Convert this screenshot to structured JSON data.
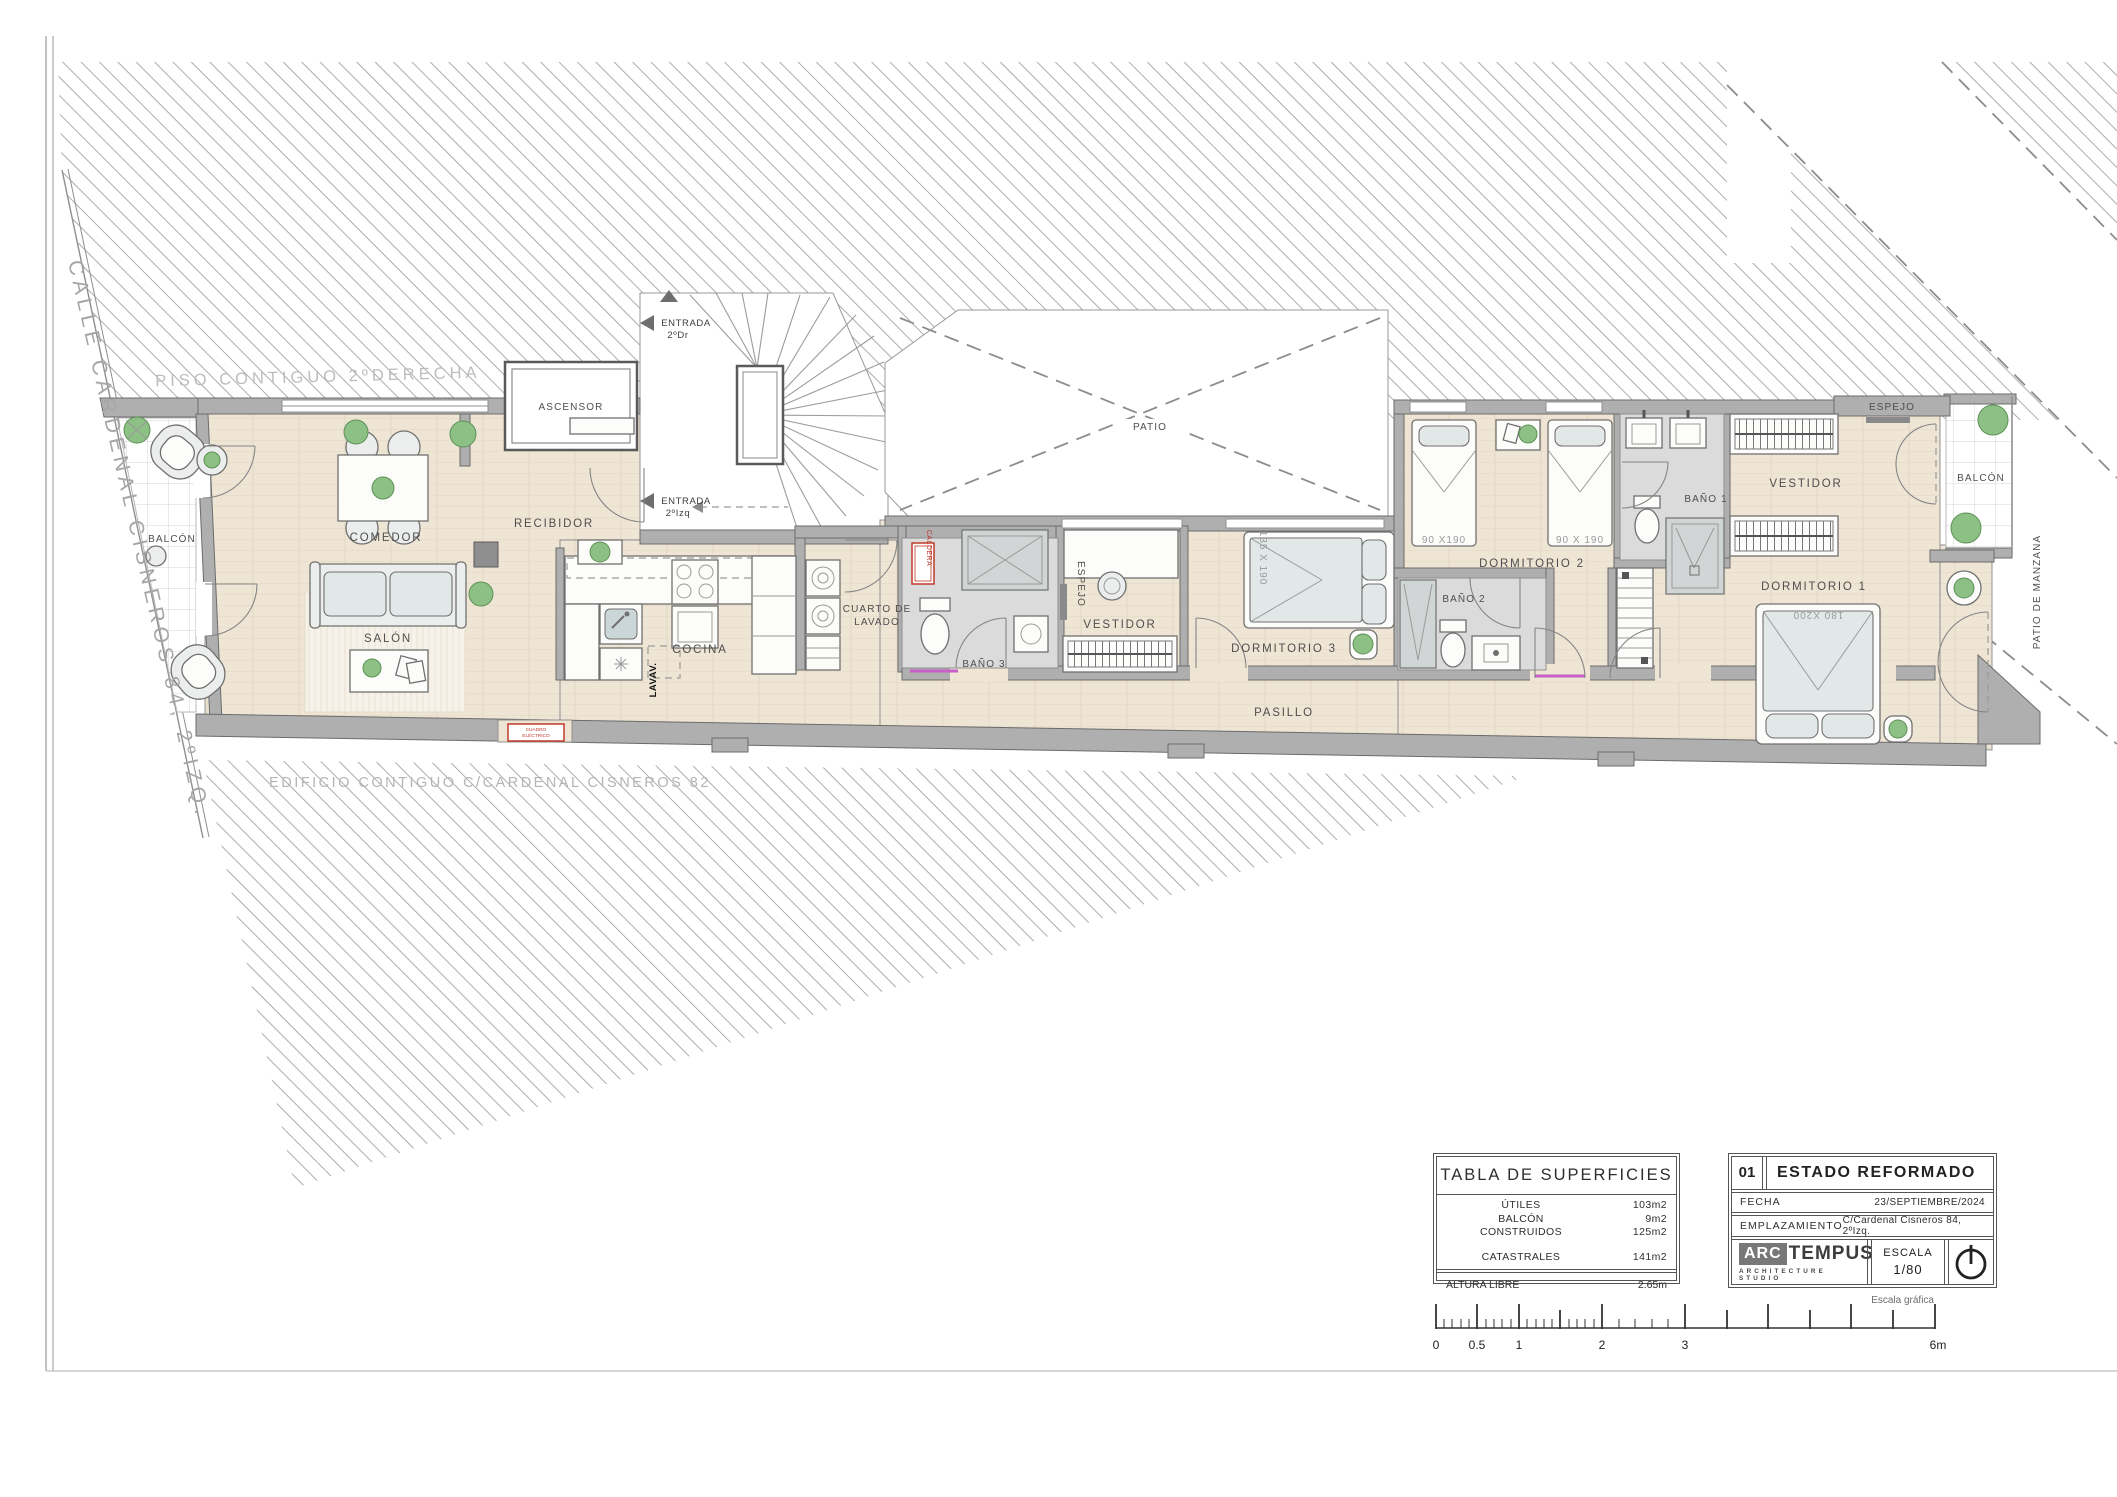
{
  "sheet": {
    "street_label": "CALLE CARDENAL CISNEROS 84, 2ºIZQ.",
    "adjacent_top": "PISO CONTIGUO 2ºDERECHA",
    "adjacent_bottom": "EDIFICIO CONTIGUO C/CARDENAL CISNEROS 82",
    "patio_label": "PATIO",
    "patio_manzana_label": "PATIO DE MANZANA"
  },
  "rooms": {
    "balcon_left": "BALCÓN",
    "comedor": "COMEDOR",
    "salon": "SALÓN",
    "recibidor": "RECIBIDOR",
    "ascensor": "ASCENSOR",
    "cocina": "COCINA",
    "cuarto_lavado_1": "CUARTO DE",
    "cuarto_lavado_2": "LAVADO",
    "bano3": "BAÑO 3",
    "espejo_mid": "ESPEJO",
    "vestidor_mid": "VESTIDOR",
    "dormitorio3": "DORMITORIO 3",
    "pasillo": "PASILLO",
    "dormitorio2": "DORMITORIO 2",
    "bano2": "BAÑO 2",
    "bano1": "BAÑO 1",
    "vestidor_right": "VESTIDOR",
    "espejo_right": "ESPEJO",
    "dormitorio1": "DORMITORIO 1",
    "balcon_right": "BALCÓN"
  },
  "annotations": {
    "entrada_dr_1": "ENTRADA",
    "entrada_dr_2": "2ºDr",
    "entrada_izq_1": "ENTRADA",
    "entrada_izq_2": "2ºIzq",
    "lavav": "LAVAV.",
    "caldera": "CALDERA",
    "cuadro_1": "CUADRO",
    "cuadro_2": "ELÉCTRICO",
    "bed_135": "135 X 190",
    "bed_90a": "90 X190",
    "bed_90b": "90 X 190",
    "bed_180": "180 X200"
  },
  "surface_table": {
    "title": "TABLA DE SUPERFICIES",
    "rows": [
      {
        "label": "ÚTILES",
        "value": "103m2"
      },
      {
        "label": "BALCÓN",
        "value": "9m2"
      },
      {
        "label": "CONSTRUIDOS",
        "value": "125m2"
      },
      {
        "label": "CATASTRALES",
        "value": "141m2"
      }
    ],
    "altura_label": "ALTURA LIBRE",
    "altura_value": "2.65m"
  },
  "title_block": {
    "number": "01",
    "title": "ESTADO  REFORMADO",
    "fecha_label": "FECHA",
    "fecha_value": "23/SEPTIEMBRE/2024",
    "emplazamiento_label": "EMPLAZAMIENTO",
    "emplazamiento_value": "C/Cardenal Cisneros 84, 2ºIzq.",
    "logo_arc": "ARC",
    "logo_tempus": "TEMPUS",
    "logo_subtitle": "ARCHITECTURE STUDIO",
    "escala_label": "ESCALA",
    "escala_value": "1/80"
  },
  "scale_bar": {
    "caption": "Escala gráfica",
    "ticks": [
      "0",
      "0.5",
      "1",
      "2",
      "3",
      "6m"
    ]
  },
  "colors": {
    "floor": "#EFE5D5",
    "wall": "#AFAFAF",
    "hatch_line": "#9E9E9E",
    "accent_red": "#C0392B",
    "accent_magenta": "#C75FC7",
    "plant_green": "#8CC084"
  }
}
